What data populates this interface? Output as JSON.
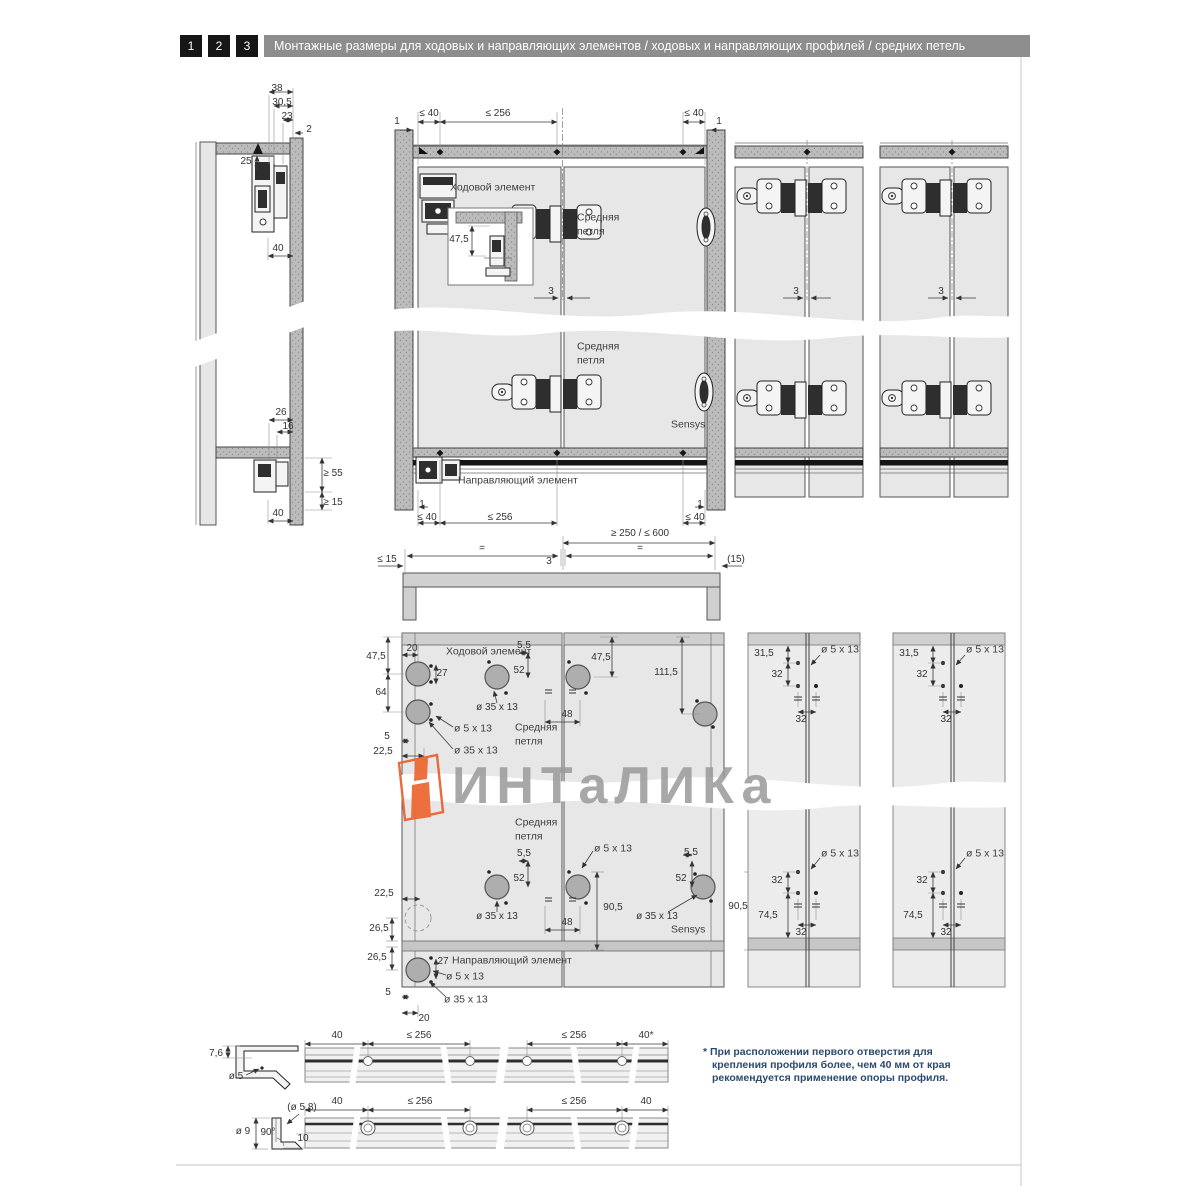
{
  "header": {
    "steps": [
      "1",
      "2",
      "3"
    ],
    "title": "Монтажные размеры для ходовых и направляющих элементов / ходовых и направляющих профилей / средних петель"
  },
  "labels": {
    "runner": "Ходовой элемент",
    "middle_hinge": "Средняя петля",
    "sensys": "Sensys",
    "guide": "Направляющий элемент"
  },
  "dims": {
    "n1": "1",
    "n2": "2",
    "n3": "3",
    "n5": "5",
    "n5_5": "5,5",
    "n7_6": "7,6",
    "n10": "10",
    "n16": "16",
    "n20": "20",
    "n22_5": "22,5",
    "n23": "23",
    "n25": "25",
    "n26": "26",
    "n26_5": "26,5",
    "n27": "27",
    "n30_5": "30,5",
    "n31_5": "31,5",
    "n32": "32",
    "n38": "38",
    "n40": "40",
    "n40_star": "40*",
    "n47_5": "47,5",
    "n48": "48",
    "n52": "52",
    "n64": "64",
    "n74_5": "74,5",
    "n90_5": "90,5",
    "n111_5": "111,5",
    "le15": "≤ 15",
    "le40": "≤ 40",
    "le256": "≤ 256",
    "ge15": "≥ 15",
    "ge55": "≥ 55",
    "range_250_600": "≥ 250 / ≤ 600",
    "p15": "(15)",
    "eq": "="
  },
  "callouts": {
    "dia5x13": "ø 5 x 13",
    "dia35x13": "ø 35 x 13",
    "dia5": "ø 5",
    "dia9": "ø 9",
    "dia5_8": "(ø 5,8)",
    "deg90": "90°"
  },
  "watermark": {
    "text": "ИНТаЛИКа",
    "accent_color": "#e96331",
    "text_color": "#9a9a9a"
  },
  "footnote": {
    "full": "* При расположении первого отверстия для крепления профиля более, чем 40 мм от края рекомендуется применение опоры профиля."
  },
  "colors": {
    "header_bar": "#8d8d8d",
    "step_bg": "#161616",
    "panel_light": "#e7e7e7",
    "rail_gray": "#bcbcbc",
    "line": "#3a3a3a",
    "hole_fill": "#aeaeae",
    "footnote_text": "#2b4a6d"
  }
}
